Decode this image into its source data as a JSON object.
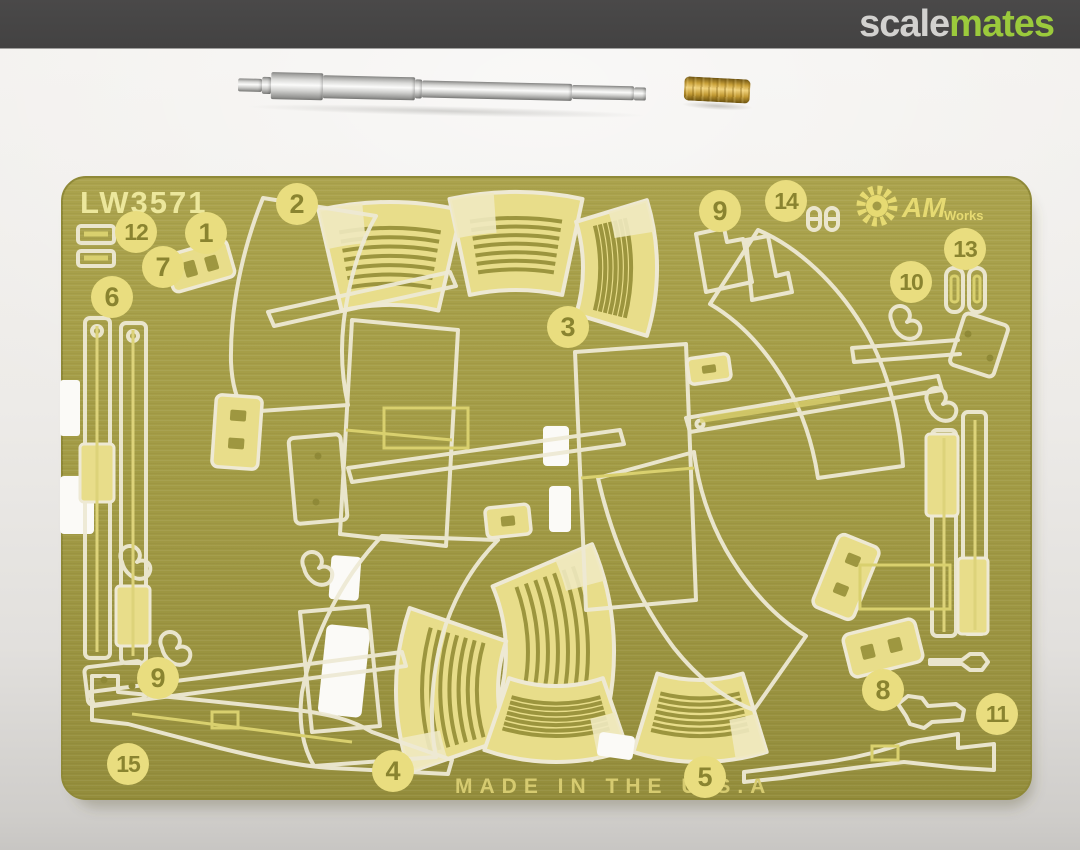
{
  "header": {
    "logo_gray": "scale",
    "logo_green": "mates"
  },
  "fret": {
    "sheet_code": "LW3571",
    "made_in_text": "MADE IN THE U.S.A",
    "brand_main": "AM",
    "brand_sub": "Works",
    "part_numbers": [
      "1",
      "2",
      "3",
      "4",
      "5",
      "6",
      "7",
      "8",
      "9",
      "10",
      "11",
      "12",
      "13",
      "14",
      "15"
    ]
  },
  "colors": {
    "logo_green": "#9BCA3C",
    "header_bg": "#434242",
    "brass_sheet": "#A29B45",
    "etch_outline": "#EEE9D4",
    "relief_yellow": "#E8DD8A",
    "numeral_olive": "#8A8430",
    "barrel_metal": "#D9D9D7",
    "muzzle_brass": "#CAA23A"
  }
}
